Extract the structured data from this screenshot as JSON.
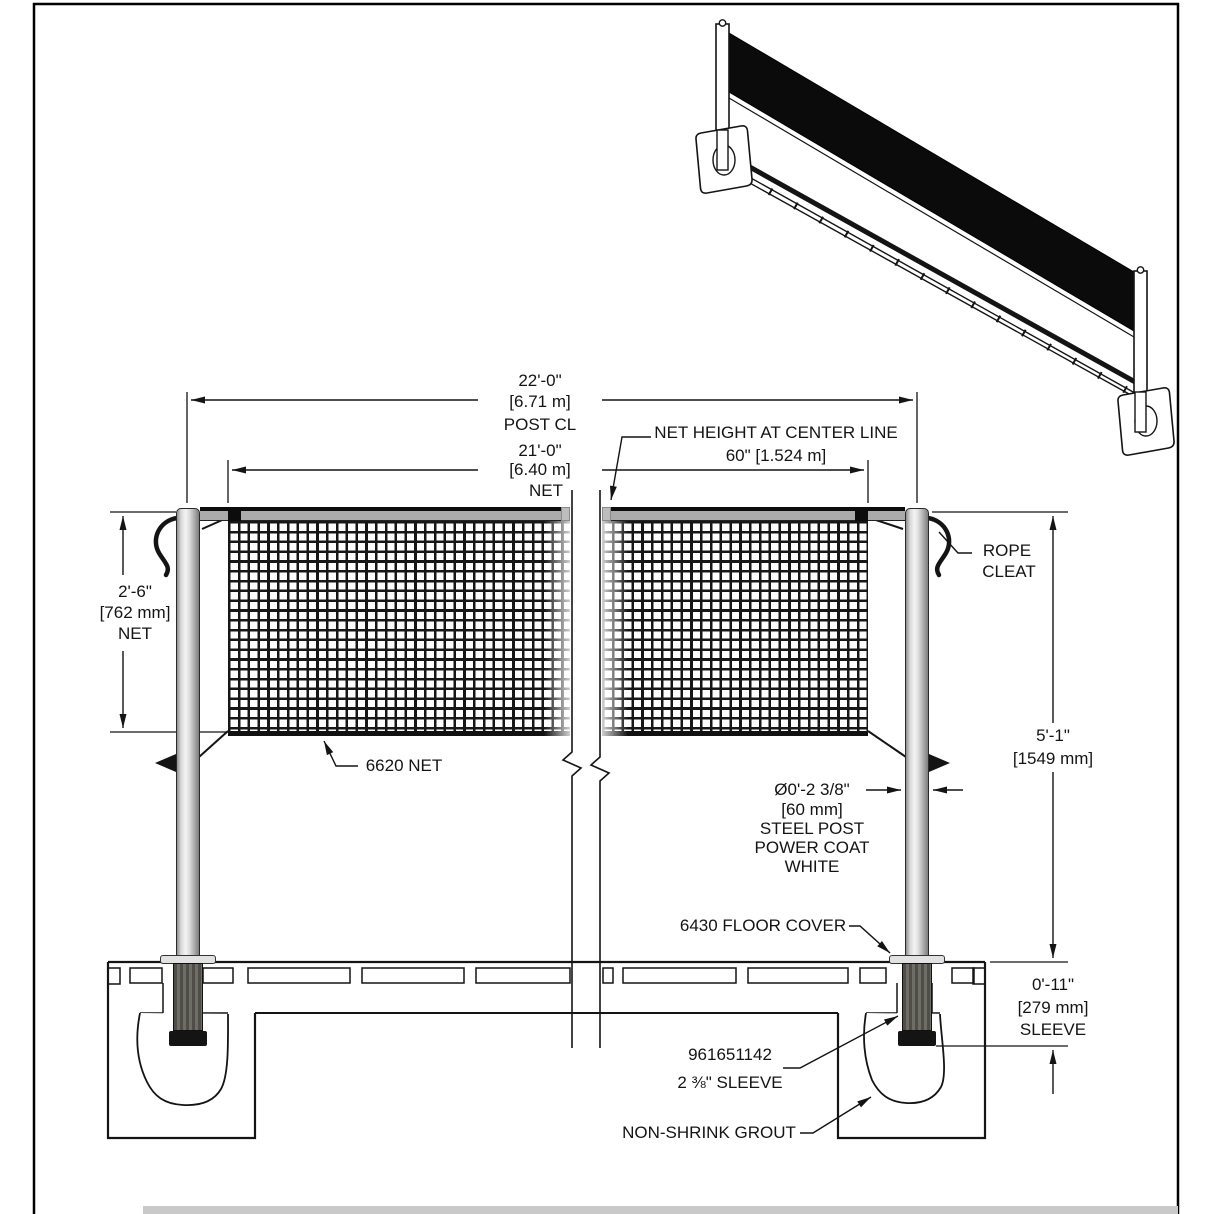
{
  "dims": {
    "post_cl": {
      "v1": "22'-0\"",
      "v2": "[6.71 m]",
      "v3": "POST CL"
    },
    "net_w": {
      "v1": "21'-0\"",
      "v2": "[6.40 m]",
      "v3": "NET"
    },
    "net_hc": {
      "v1": "NET HEIGHT AT CENTER LINE",
      "v2": "60\" [1.524 m]"
    },
    "net_d": {
      "v1": "2'-6\"",
      "v2": "[762 mm]",
      "v3": "NET"
    },
    "post_h": {
      "v1": "5'-1\"",
      "v2": "[1549 mm]"
    },
    "sleeve_d": {
      "v1": "0'-11\"",
      "v2": "[279 mm]",
      "v3": "SLEEVE"
    },
    "post_dia": {
      "v1": "Ø0'-2 3/8\"",
      "v2": "[60 mm]",
      "v3": "STEEL POST",
      "v4": "POWER COAT",
      "v5": "WHITE"
    }
  },
  "callouts": {
    "rope1": "ROPE",
    "rope2": "CLEAT",
    "net": "6620 NET",
    "floor_cover": "6430 FLOOR COVER",
    "part_no": "961651142",
    "sleeve_size": "2 ⅜\" SLEEVE",
    "grout": "NON-SHRINK GROUT"
  },
  "colors": {
    "line": "#141414",
    "post_metal_light": "#f4f4f4",
    "post_metal_dark": "#7d7d7d",
    "band_gray": "#ababab",
    "sleeve_dark": "#55534c",
    "cap_black": "#141414",
    "iso_net_black": "#0b0b0b",
    "bottom_strip": "#c9c9c9"
  }
}
